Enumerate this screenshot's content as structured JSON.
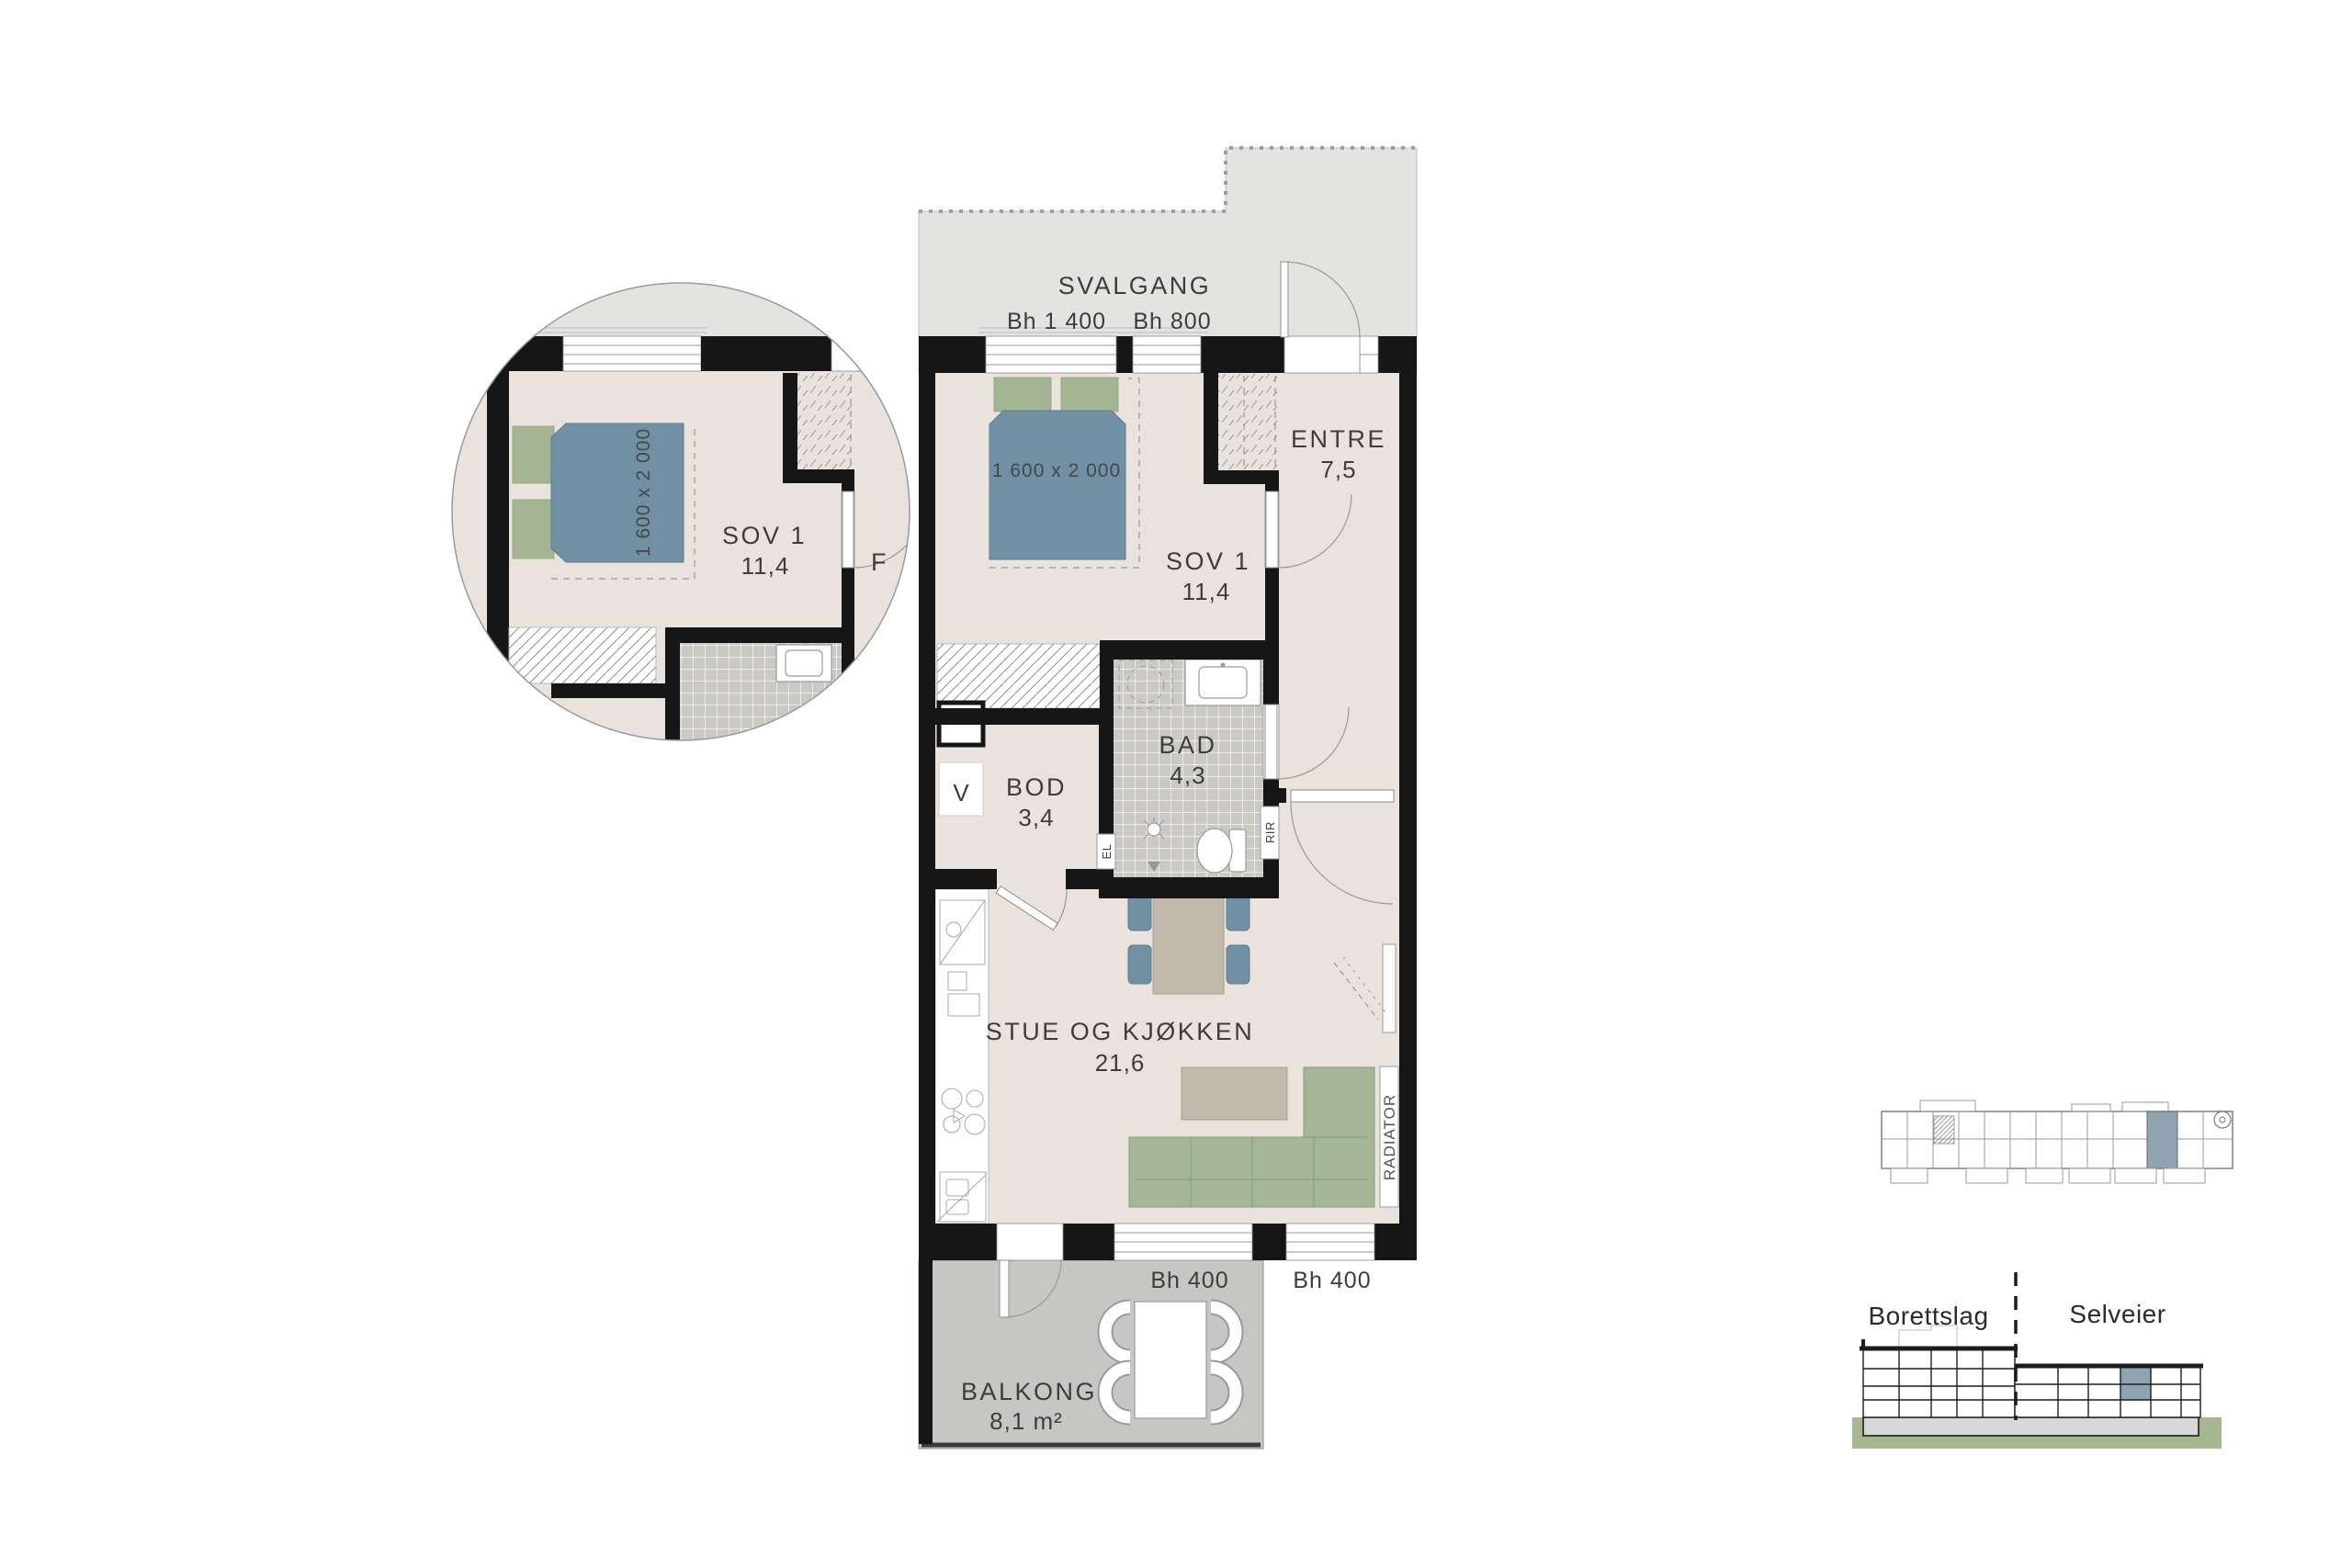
{
  "plan": {
    "svalgang_label": "SVALGANG",
    "bh": {
      "left": "Bh 1 400",
      "right": "Bh 800"
    },
    "bed_dimension": "1 600 x 2 000",
    "rooms": {
      "sov1": {
        "name": "SOV 1",
        "area": "11,4"
      },
      "entre": {
        "name": "ENTRE",
        "area": "7,5"
      },
      "bad": {
        "name": "BAD",
        "area": "4,3"
      },
      "bod": {
        "name": "BOD",
        "area": "3,4"
      },
      "stue": {
        "name": "STUE OG KJØKKEN",
        "area": "21,6"
      },
      "balkong": {
        "name": "BALKONG",
        "area": "8,1 m²"
      }
    },
    "equipment": {
      "ventilation": "V",
      "el": "EL",
      "rir": "RIR",
      "radiator": "RADIATOR"
    },
    "bh400": {
      "left": "Bh 400",
      "right": "Bh 400"
    }
  },
  "detail": {
    "room": "SOV 1",
    "area": "11,4",
    "bed_dimension": "1 600 x 2 000",
    "clipped_label": "F"
  },
  "section": {
    "left": "Borettslag",
    "right": "Selveier"
  },
  "colors": {
    "floor": "#EAE2DD",
    "svalgang": "#E3E3E2",
    "balcony": "#C6C6C5",
    "wall": "#161616",
    "tile": "#CAC9C4",
    "bed": "#7190A4",
    "pillow": "#A4B593",
    "sofa": "#A4B695",
    "table": "#C1B9AC",
    "chair": "#7190A4",
    "highlight": "#8FA3B0",
    "ground": "#A5B690",
    "slab": "#D7D7D7",
    "ink": "#3D3D3D"
  }
}
